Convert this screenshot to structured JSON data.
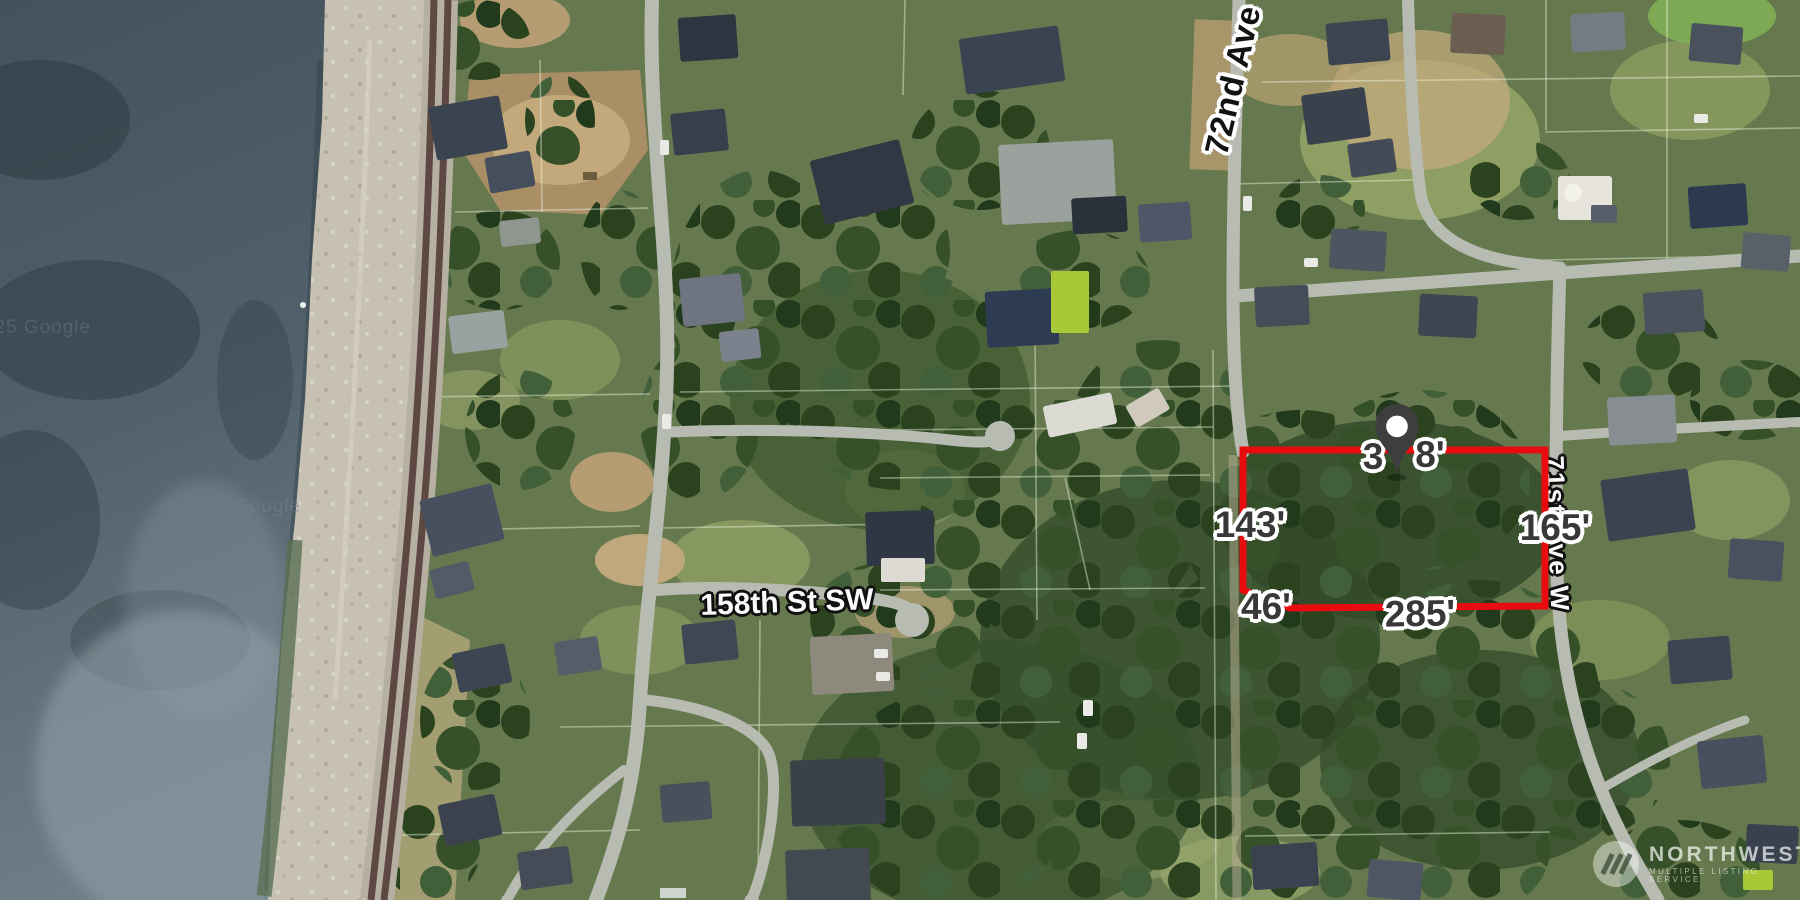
{
  "map": {
    "streets": {
      "ave72": "72nd Ave",
      "st158": "158th St SW",
      "ave71": "71st Ave W"
    },
    "parcel": {
      "dim_left": "143'",
      "dim_bottom_small": "46'",
      "dim_bottom": "285'",
      "dim_right": "165'",
      "dim_top_fragment_left": "3",
      "dim_top_fragment_right": "8'",
      "outline_color": "#e80b0f"
    },
    "marker": {
      "color": "#3e3e3e"
    },
    "watermarks": {
      "google": "© 2025 Google",
      "google_edge": "© 2025 Google"
    },
    "logo": {
      "title": "NORTHWEST",
      "subtitle": "MULTIPLE LISTING SERVICE"
    }
  }
}
